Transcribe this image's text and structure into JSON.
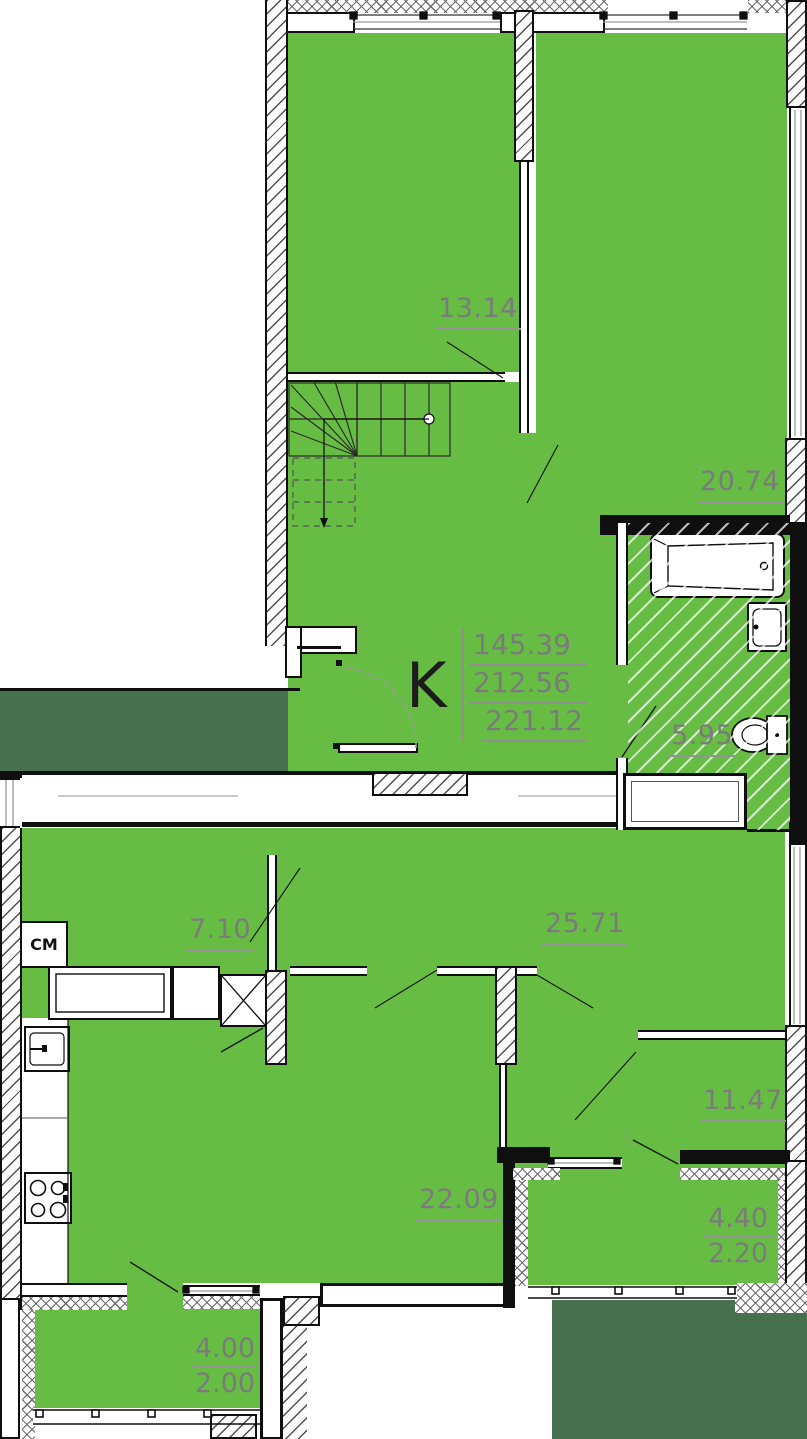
{
  "plan": {
    "legend": {
      "kitchen_zone_label": "K",
      "washing_machine_label": "CM"
    },
    "area_summary": {
      "values": [
        "145.39",
        "212.56",
        "221.12"
      ]
    },
    "rooms": [
      {
        "area": "13.14"
      },
      {
        "area": "20.74"
      },
      {
        "area": "5.95"
      },
      {
        "area": "7.10"
      },
      {
        "area": "25.71"
      },
      {
        "area": "22.09"
      },
      {
        "area": "11.47"
      }
    ],
    "balconies": [
      {
        "area_full": "4.00",
        "area_reduced": "2.00"
      },
      {
        "area_full": "4.40",
        "area_reduced": "2.20"
      }
    ],
    "colors": {
      "room_fill": "#67bd44",
      "outside_fill": "#47704f",
      "wall": "#0f0f0f",
      "area_label": "#7b7b7b"
    }
  }
}
